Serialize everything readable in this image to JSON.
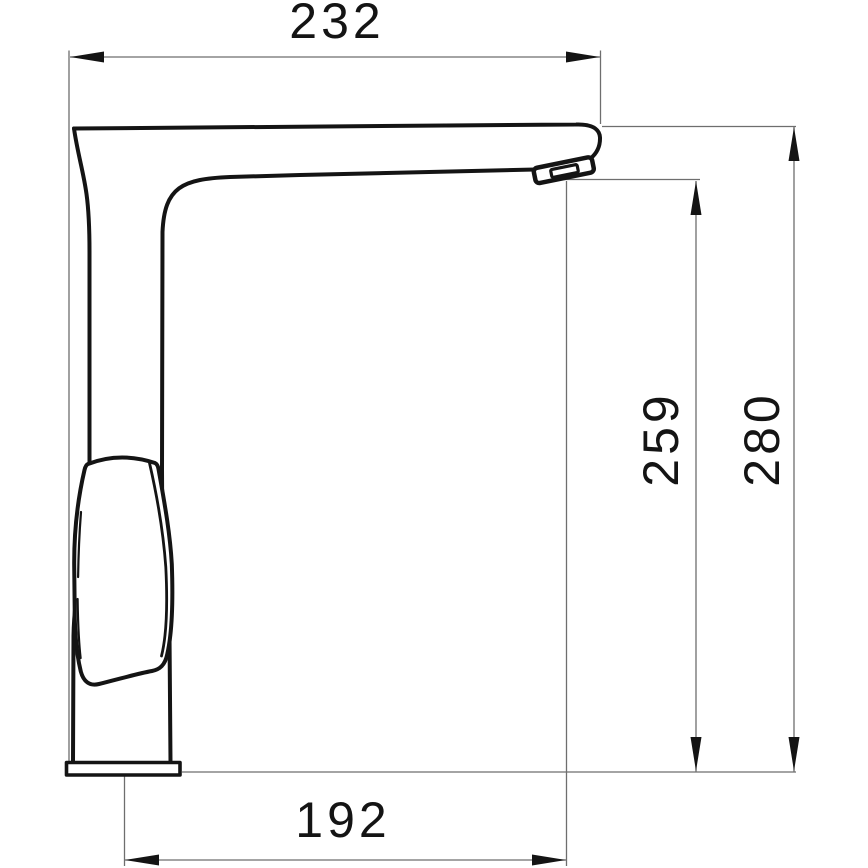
{
  "drawing": {
    "background": "#ffffff",
    "outline_color": "#141414",
    "dim_line_color": "#6e6e6e",
    "dimensions": {
      "top": "232",
      "right_inner": "259",
      "right_outer": "280",
      "bottom": "192"
    }
  }
}
